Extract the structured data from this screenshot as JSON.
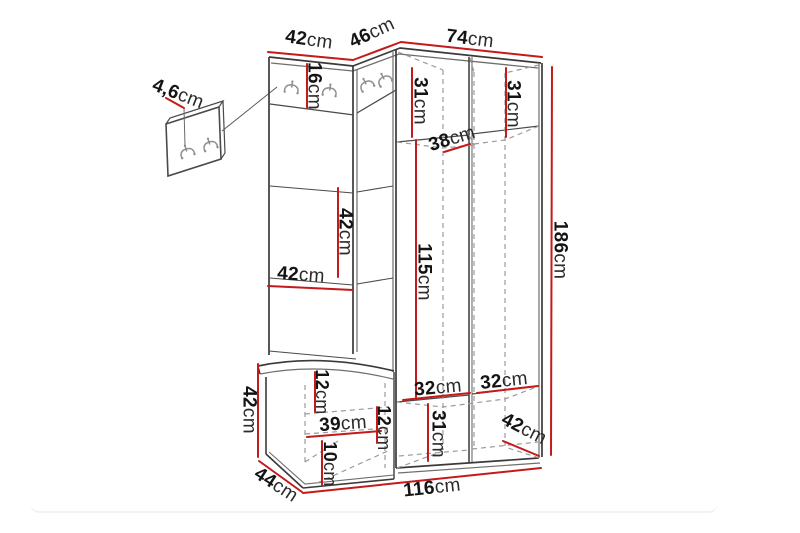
{
  "diagram": {
    "title": "Hallway furniture set dimension diagram",
    "unit_suffix": "cm",
    "colors": {
      "outline": "#3a3a3a",
      "secondary_line": "#6e6e6e",
      "dashed_line": "#9b9b9b",
      "dimension_line": "#c51a1a",
      "text": "#141414",
      "hook": "#8f8f8f",
      "background": "#ffffff"
    },
    "dimensions": {
      "panel_thickness": {
        "value": "4,6",
        "unit": "cm"
      },
      "top_left_width": {
        "value": "42",
        "unit": "cm"
      },
      "corner_width": {
        "value": "46",
        "unit": "cm"
      },
      "wardrobe_width": {
        "value": "74",
        "unit": "cm"
      },
      "hook_board_height": {
        "value": "16",
        "unit": "cm"
      },
      "left_top_compartment_height": {
        "value": "31",
        "unit": "cm"
      },
      "right_top_compartment_height": {
        "value": "31",
        "unit": "cm"
      },
      "corner_shelf_depth": {
        "value": "38",
        "unit": "cm"
      },
      "panel_height": {
        "value": "42",
        "unit": "cm"
      },
      "panel_width": {
        "value": "42",
        "unit": "cm"
      },
      "hanging_space_height": {
        "value": "115",
        "unit": "cm"
      },
      "total_height": {
        "value": "186",
        "unit": "cm"
      },
      "bench_height": {
        "value": "42",
        "unit": "cm"
      },
      "seat_thickness": {
        "value": "12",
        "unit": "cm"
      },
      "bench_niche_width": {
        "value": "39",
        "unit": "cm"
      },
      "bench_niche_height": {
        "value": "12",
        "unit": "cm"
      },
      "bench_plinth_height": {
        "value": "10",
        "unit": "cm"
      },
      "bench_depth": {
        "value": "44",
        "unit": "cm"
      },
      "left_compartment_width": {
        "value": "32",
        "unit": "cm"
      },
      "right_compartment_width": {
        "value": "32",
        "unit": "cm"
      },
      "bottom_compartment_height": {
        "value": "31",
        "unit": "cm"
      },
      "wardrobe_depth": {
        "value": "42",
        "unit": "cm"
      },
      "total_width": {
        "value": "116",
        "unit": "cm"
      }
    }
  }
}
